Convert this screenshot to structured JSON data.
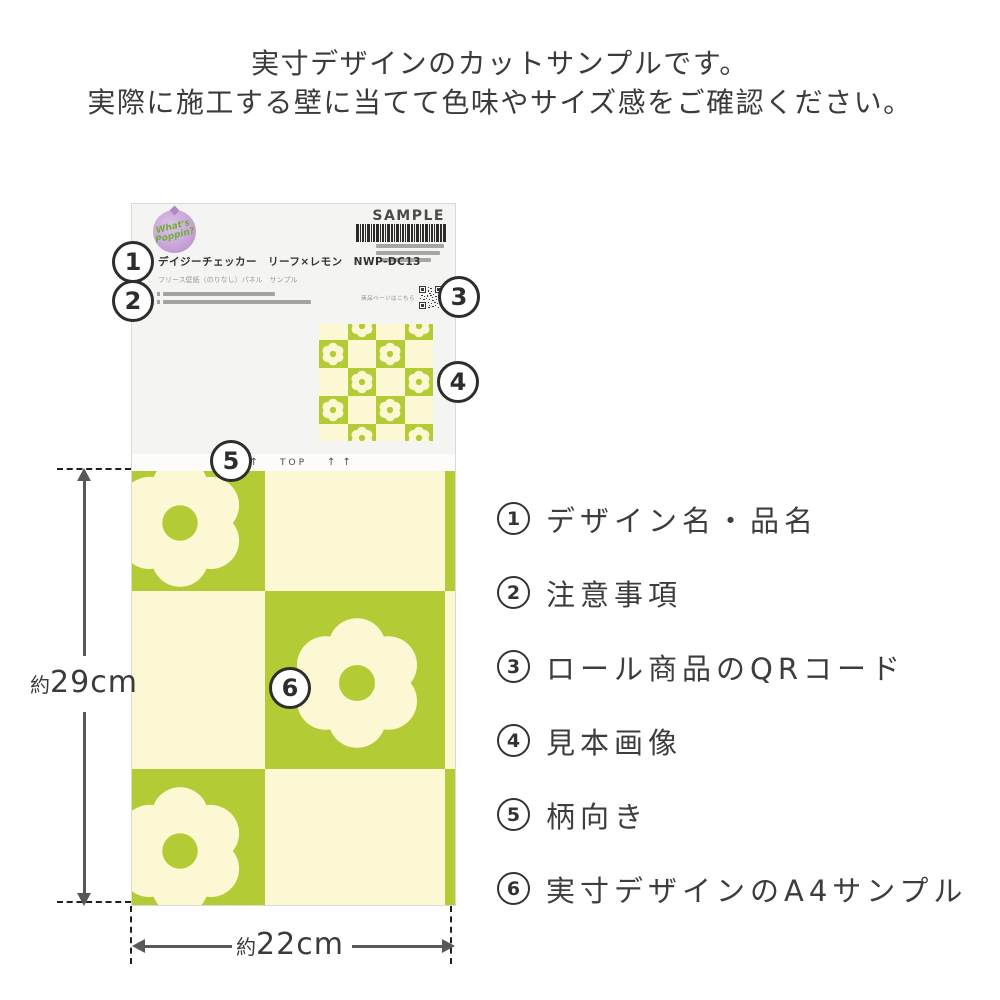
{
  "instructions": {
    "line1": "実寸デザインのカットサンプルです。",
    "line2": "実際に施工する壁に当てて色味やサイズ感をご確認ください。"
  },
  "card": {
    "logo": {
      "line1": "What's",
      "line2": "Poppin?"
    },
    "sample_label": "SAMPLE",
    "product_name": "デイジーチェッカー　リーフ×レモン　NWP-DC13",
    "product_subtitle": "フリース壁紙（のりなし）パネル　サンプル",
    "qr_caption": "商品ページはこちら",
    "orientation": {
      "arrows_left": "↑ ↑",
      "label": "TOP",
      "arrows_right": "↑ ↑"
    }
  },
  "callouts": [
    "1",
    "2",
    "3",
    "4",
    "5",
    "6"
  ],
  "dimensions": {
    "height": {
      "prefix": "約",
      "value": "29cm"
    },
    "width": {
      "prefix": "約",
      "value": "22cm"
    }
  },
  "legend": {
    "items": [
      {
        "num": "1",
        "label": "デザイン名・品名"
      },
      {
        "num": "2",
        "label": "注意事項"
      },
      {
        "num": "3",
        "label": "ロール商品のQRコード"
      },
      {
        "num": "4",
        "label": "見本画像"
      },
      {
        "num": "5",
        "label": "柄向き"
      },
      {
        "num": "6",
        "label": "実寸デザインのA4サンプル"
      }
    ]
  },
  "colors": {
    "pattern_green": "#b3cb35",
    "pattern_cream": "#fbf8d3",
    "logo_purple": "#c9a6d8",
    "logo_text_green": "#6fae3a",
    "text_dark": "#3b3b3b",
    "arrow_gray": "#58585a"
  }
}
